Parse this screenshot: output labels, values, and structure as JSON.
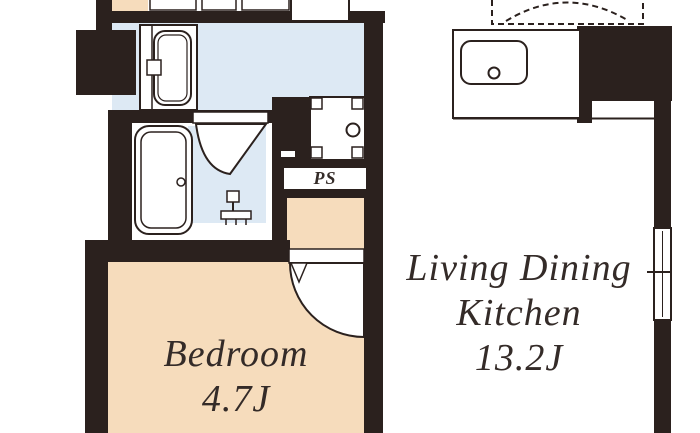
{
  "plan_type": "apartment-floor-plan",
  "labels": {
    "ldk": {
      "line1": "Living Dining",
      "line2": "Kitchen",
      "area": "13.2J"
    },
    "bedroom": {
      "name": "Bedroom",
      "area": "4.7J"
    },
    "ps": {
      "label": "PS"
    }
  },
  "rooms": [
    {
      "name": "Living Dining Kitchen",
      "area": "13.2J"
    },
    {
      "name": "Bedroom",
      "area": "4.7J"
    },
    {
      "name": "PS",
      "area": ""
    }
  ],
  "fixtures": [
    "refrigerator-space-dashed",
    "kitchen-counter-with-sink",
    "washing-machine-pan",
    "washbasin-vanity",
    "bathtub",
    "shower-room-folding-door",
    "shower-faucet",
    "bedroom-swing-door",
    "bathroom-threshold",
    "window-right-wall",
    "pipe-space"
  ],
  "colors": {
    "wall": "#2b211e",
    "wet_area_floor": "#dde9f4",
    "wood_floor": "#f6dcbc",
    "ldk_floor": "#ffffff",
    "outline": "#2b211e",
    "text": "#342b28"
  }
}
